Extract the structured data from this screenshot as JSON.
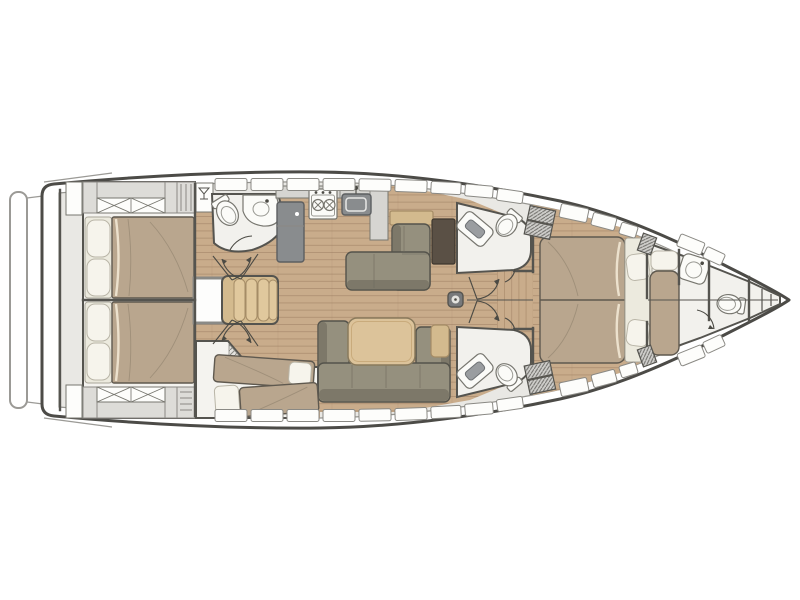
{
  "diagram": {
    "type": "yacht-interior-floor-plan",
    "view": "top-down",
    "orientation": "bow-right",
    "visible_text": []
  },
  "colors": {
    "background": "#ffffff",
    "hull_outline": "#4c4b47",
    "deck_band": "#e9e8e4",
    "deck_edge": "#969590",
    "platform_edge": "#9b9a96",
    "interior_wall": "#55544f",
    "window_white": "#fdfdfb",
    "wood_floor": "#c9ac8b",
    "wood_plank_line": "#96785a",
    "head_floor": "#f2f1ed",
    "cabin_floor": "#f4f3ef",
    "mattress": "#b9a68e",
    "mattress_outline": "#5f594f",
    "pillow": "#f6f4ec",
    "pillow_outline": "#b9b5a7",
    "sofa_seat": "#95907e",
    "sofa_back": "#7d7869",
    "sofa_outline": "#54534b",
    "table_wood": "#dcc39a",
    "table_outline": "#8a7a5c",
    "shelf_wood": "#d3ba8e",
    "stairs_wood": "#d3ba8e",
    "counter": "#d6d5d1",
    "appliance_gray": "#898c8e",
    "appliance_edge": "#5c5e60",
    "fixture_white": "#fbfbf8",
    "fixture_outline": "#77766f",
    "nav_desk_brown": "#5a5045",
    "hatch_line": "#6f6e6a",
    "door_arc": "#4b4a44"
  },
  "rooms": [
    {
      "id": "aft-cabin-port",
      "name": "aft double cabin port",
      "features": [
        "double-bed",
        "pillows",
        "wardrobe-x-lockers",
        "shelf-cabinet",
        "side-door"
      ]
    },
    {
      "id": "aft-cabin-starboard",
      "name": "aft double cabin starboard",
      "features": [
        "double-bed",
        "pillows",
        "wardrobe-x-lockers",
        "shelf-cabinet",
        "side-door"
      ]
    },
    {
      "id": "companionway",
      "name": "companionway",
      "features": [
        "stairs",
        "engine-hatch",
        "wet-bar-port",
        "wet-bar-starboard"
      ]
    },
    {
      "id": "aft-head-port",
      "name": "aft head port",
      "features": [
        "toilet",
        "sink-counter",
        "door-swing"
      ]
    },
    {
      "id": "galley",
      "name": "galley",
      "features": [
        "refrigerator",
        "stove-two-burner",
        "sink",
        "counter"
      ]
    },
    {
      "id": "nav-station",
      "name": "navigation station",
      "features": [
        "l-shaped-settee",
        "chart-desk",
        "shelf"
      ]
    },
    {
      "id": "salon-dinette",
      "name": "salon dinette",
      "features": [
        "u-shaped-sofa",
        "dining-table",
        "side-shelf"
      ]
    },
    {
      "id": "bunk-cabin-starboard",
      "name": "bunk cabin starboard",
      "features": [
        "single-bed-upper",
        "single-bed-lower",
        "pillows",
        "louvered-wall"
      ]
    },
    {
      "id": "forward-head-port",
      "name": "forward head port",
      "features": [
        "toilet",
        "vanity-sink",
        "door-swing"
      ]
    },
    {
      "id": "forward-head-starboard",
      "name": "forward head starboard",
      "features": [
        "toilet",
        "vanity-sink",
        "door-swing"
      ]
    },
    {
      "id": "owner-cabin-forward",
      "name": "owner cabin forward",
      "features": [
        "island-double-bed",
        "pillows",
        "corridor"
      ]
    },
    {
      "id": "bow-compartment",
      "name": "bow crew berth and head",
      "features": [
        "single-berth",
        "pillow",
        "sink",
        "toilet",
        "shelves",
        "door-swing"
      ]
    }
  ],
  "deck_features": [
    "swim-platform",
    "deck-window-strips",
    "deck-hatch-gratings",
    "mast-foot",
    "centerline"
  ]
}
